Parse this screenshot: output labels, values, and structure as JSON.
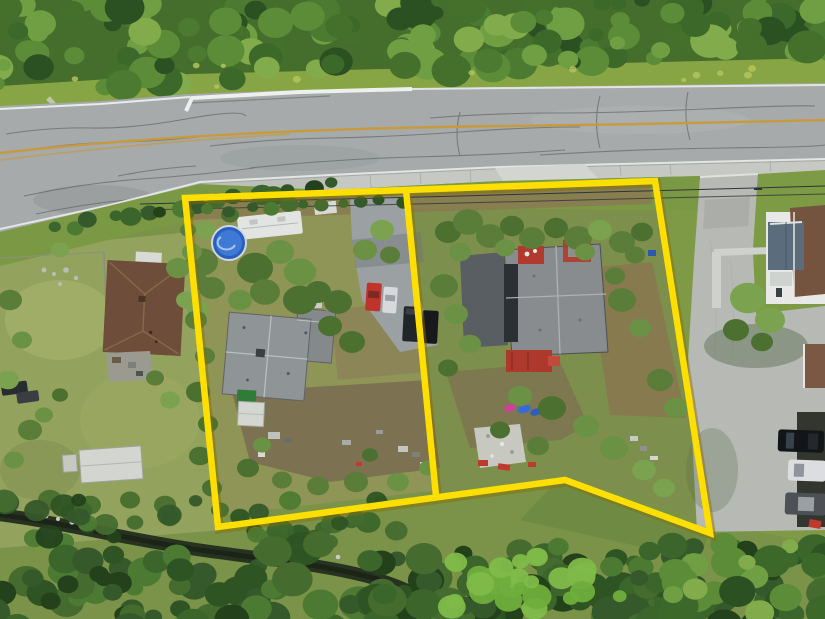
{
  "scene": {
    "type": "aerial-drone-photo",
    "description": "Aerial drone photo of two adjacent residential lots outlined with a thick yellow property boundary, beside a cracked two-lane road with a yellow center line, surrounded by dense trees, neighboring houses, a concrete parking area with cars, and a creek running through forest at the bottom",
    "lots_outlined": 2,
    "annotation_style": "yellow property line overlay"
  },
  "palette": {
    "boundary_yellow": "#ffdf00",
    "boundary_shadow": "#8a6d00",
    "road_asphalt": "#a6aaab",
    "road_center_line": "#c79a3e",
    "road_edge_white": "#e9ebe9",
    "sidewalk": "#c6c8c3",
    "concrete_driveway": "#b6b9b4",
    "grass_verge": "#87a544",
    "dry_yard": "#93a25c",
    "dirt_yard": "#7c7150",
    "forest_dark": "#2b5022",
    "creek_water": "#273320",
    "left_house_roof": "#8f9496",
    "right_house_roof": "#888c8e",
    "right_house_shadow_wing": "#585e61",
    "neighbor_left_roof": "#6e4e3b",
    "neighbor_right_roof_brown": "#74533f",
    "neighbor_right_roof_blue": "#5b6d7d",
    "pool_blue": "#2a5fc0",
    "deck_red": "#b13a2e",
    "rv_white": "#e2e4e1",
    "car_red": "#c0332a",
    "car_white": "#dbdde0",
    "van_dark": "#212529",
    "suv_black": "#131619"
  },
  "objects": [
    "road",
    "sidewalk",
    "retaining-wall",
    "power-lines",
    "property-boundary",
    "lot-divider-line",
    "left-lot-house",
    "right-lot-house",
    "above-ground-pool",
    "rv-trailer",
    "parking-pad-vehicles",
    "white-shed",
    "green-tarp",
    "kayaks",
    "red-deck",
    "left-neighbor-house",
    "right-neighbor-house",
    "concrete-parking-area",
    "parked-cars",
    "creek",
    "forest"
  ]
}
